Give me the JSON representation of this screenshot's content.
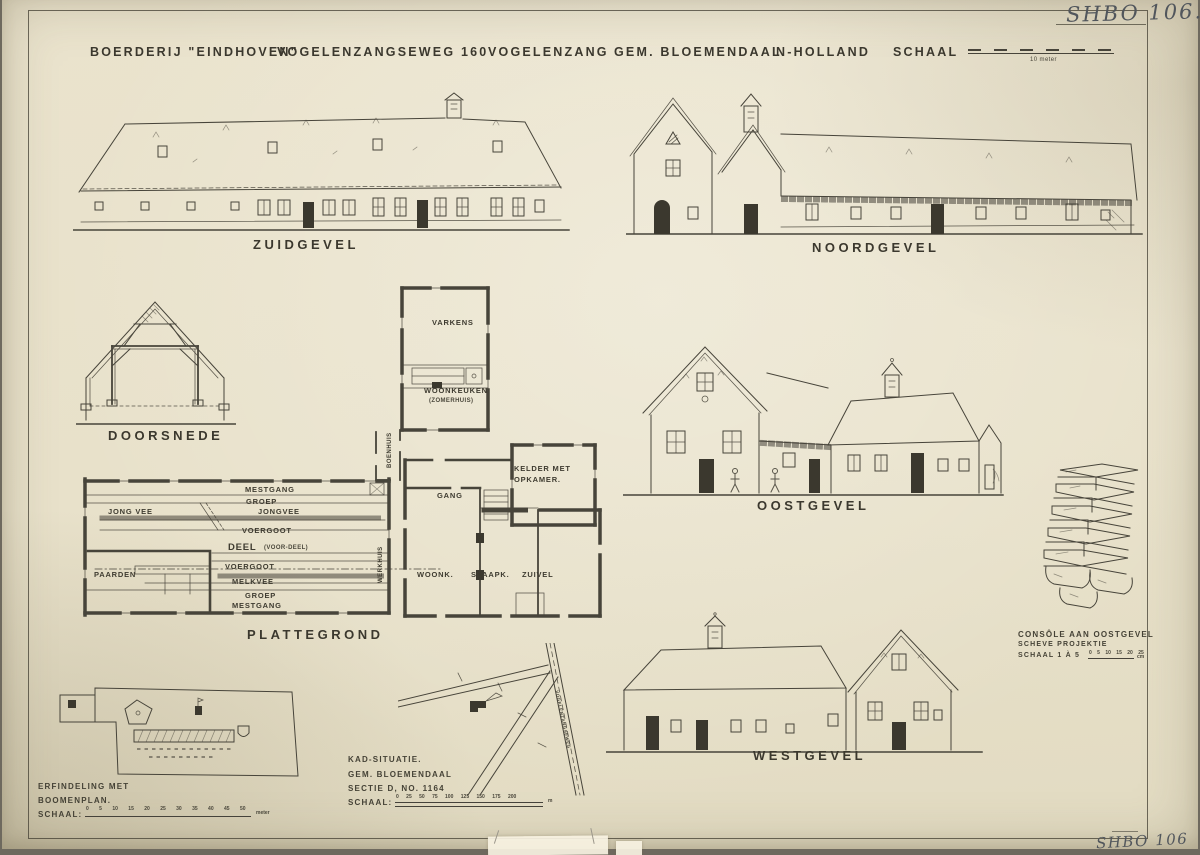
{
  "colors": {
    "paper": "#e8e1ca",
    "ink": "#444135",
    "pencil": "#565a60"
  },
  "archive": {
    "mark_top": "SHBO 106.",
    "mark_bottom": "SHBO 106"
  },
  "title": {
    "p1": "BOERDERIJ \"EINDHOVEN\"",
    "p2": "VOGELENZANGSEWEG 160",
    "p3": "VOGELENZANG",
    "p4": "GEM. BLOEMENDAAL",
    "p5": "N-HOLLAND",
    "p6": "SCHAAL",
    "scale_caption": "10 meter"
  },
  "captions": {
    "zuidgevel": "ZUIDGEVEL",
    "noordgevel": "NOORDGEVEL",
    "doorsnede": "DOORSNEDE",
    "plattegrond": "PLATTEGROND",
    "oostgevel": "OOSTGEVEL",
    "westgevel": "WESTGEVEL"
  },
  "plan": {
    "mestgang_top": "MESTGANG",
    "groep_top": "GROEP",
    "jong_vee": "JONG VEE",
    "jongvee": "JONGVEE",
    "voergoot_top": "VOERGOOT",
    "deel": "DEEL",
    "deel_sub": "(VOOR-DEEL)",
    "voergoot_mid": "VOERGOOT",
    "melkvee": "MELKVEE",
    "groep_bottom": "GROEP",
    "mestgang_bottom": "MESTGANG",
    "paarden": "PAARDEN",
    "varkens": "VARKENS",
    "woonkeuken": "WOONKEUKEN",
    "woonkeuken_sub": "(ZOMERHUIS)",
    "kelder_1": "KELDER MET",
    "kelder_2": "OPKAMER.",
    "gang": "GANG",
    "woonk": "WOONK.",
    "slaapk": "SLAAPK.",
    "zuivel": "ZUIVEL",
    "boenhuis": "BOENHUIS",
    "werkhuis": "WERKHUIS"
  },
  "console": {
    "line1": "CONSÔLE AAN OOSTGEVEL",
    "line2": "SCHEVE PROJEKTIE",
    "line3": "SCHAAL 1 À 5",
    "ticks": "0 5 10 15 20 25",
    "unit": "cm"
  },
  "erf": {
    "line1": "ERFINDELING MET",
    "line2": "BOOMENPLAN.",
    "line3": "SCHAAL:",
    "ticks": "0 5 10 15 20 25 30 35 40 45 50",
    "unit": "meter"
  },
  "kad": {
    "line1": "KAD-SITUATIE.",
    "line2": "GEM. BLOEMENDAAL",
    "line3": "SECTIE D, NO. 1164",
    "line4": "SCHAAL:",
    "ticks": "0 25 50 75 100 125 150 175 200",
    "unit": "m",
    "road": "VOGELENZANGSEWEG"
  }
}
